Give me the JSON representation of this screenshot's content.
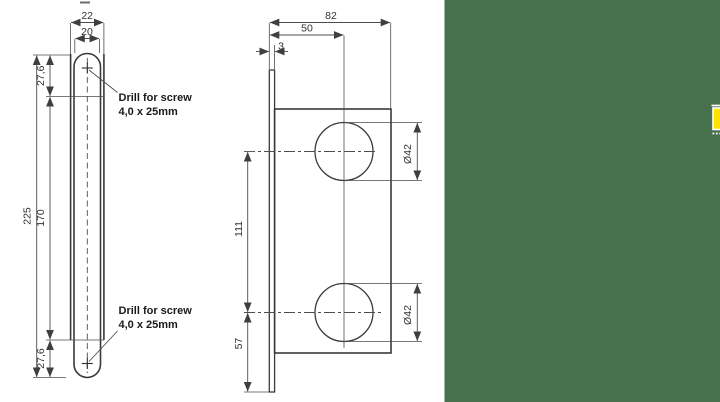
{
  "colors": {
    "panel_green": "#47704C",
    "marker_yellow": "#FFE200",
    "plate_fill": "#D9D9D9",
    "outline": "#3A3A3A",
    "dim_text": "#333333"
  },
  "front_view": {
    "width_outer": "22",
    "width_inner": "20",
    "offset_top": "27,6",
    "height_overall": "225",
    "hole_spacing": "170",
    "offset_bottom": "27,6",
    "note_top": {
      "line1": "Drill for screw",
      "line2": "4,0 x 25mm"
    },
    "note_bottom": {
      "line1": "Drill for screw",
      "line2": "4,0 x 25mm"
    }
  },
  "side_view": {
    "depth_overall": "82",
    "hole_center_depth": "50",
    "faceplate_thickness": "3",
    "hole_top_diameter": "Ø42",
    "hole_bottom_diameter": "Ø42",
    "hole_spacing": "111",
    "offset_bottom": "57"
  }
}
